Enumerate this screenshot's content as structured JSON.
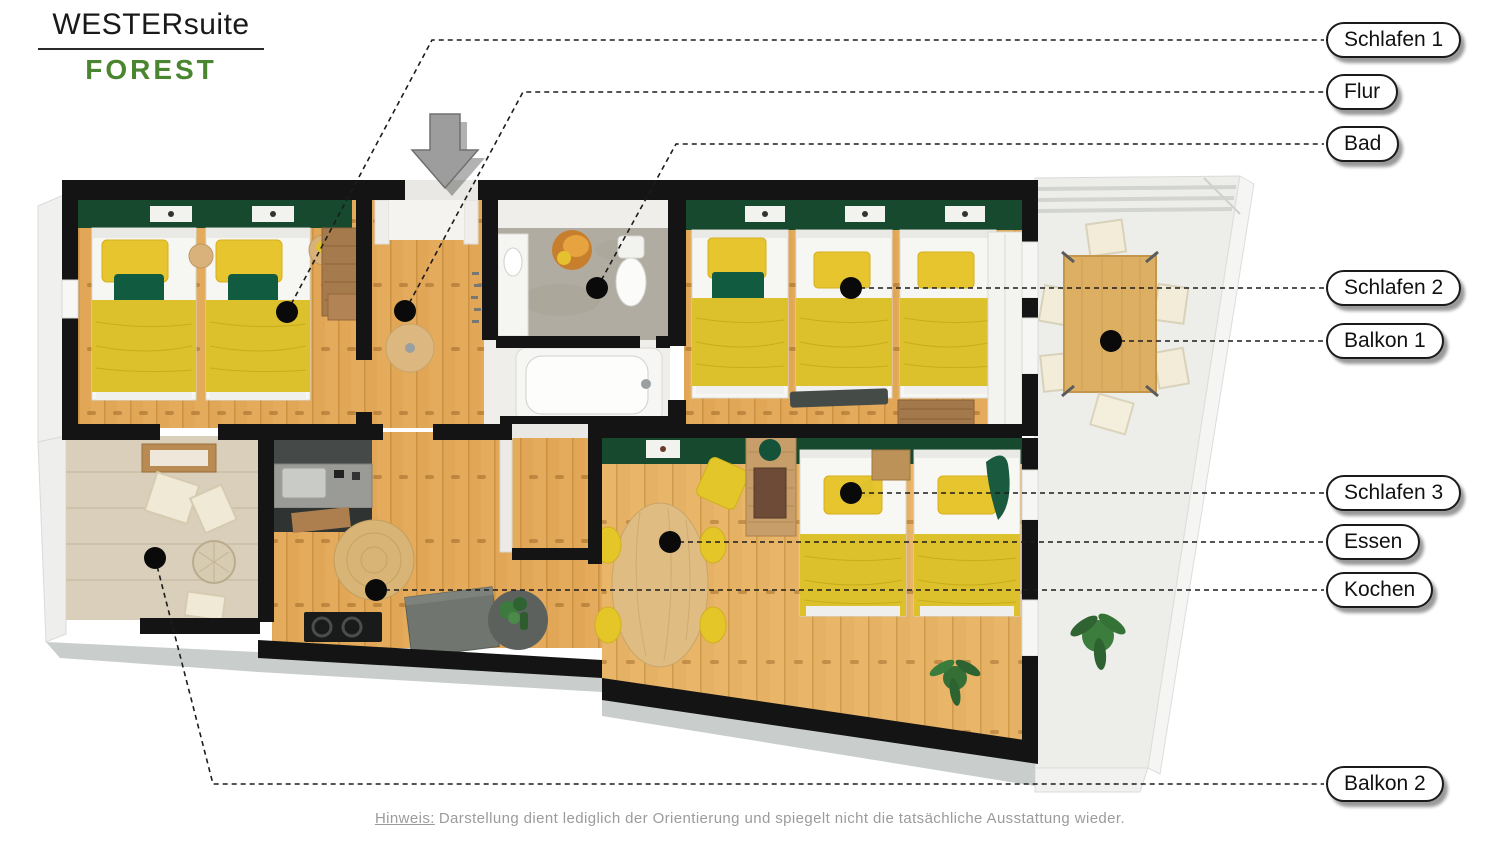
{
  "logo": {
    "brand": "WESTERsuite",
    "variant": "FOREST"
  },
  "note": {
    "prefix": "Hinweis:",
    "text": "Darstellung dient lediglich der Orientierung und spiegelt nicht die tatsächliche Ausstattung wieder."
  },
  "colors": {
    "accent_green": "#4a8530",
    "wall_green": "#17492f",
    "wood_floor": "#e1a757",
    "blanket_yellow": "#ddc12c",
    "marker_black": "#0a0a0a",
    "wall_black": "#141414"
  },
  "labels": [
    {
      "id": "schlafen-1",
      "text": "Schlafen 1",
      "dot": [
        287,
        312
      ],
      "path": [
        [
          287,
          312
        ],
        [
          432,
          40
        ],
        [
          1324,
          40
        ]
      ],
      "pill_y": 40
    },
    {
      "id": "flur",
      "text": "Flur",
      "dot": [
        405,
        311
      ],
      "path": [
        [
          405,
          311
        ],
        [
          523,
          92
        ],
        [
          1324,
          92
        ]
      ],
      "pill_y": 92
    },
    {
      "id": "bad",
      "text": "Bad",
      "dot": [
        597,
        288
      ],
      "path": [
        [
          597,
          288
        ],
        [
          676,
          144
        ],
        [
          1324,
          144
        ]
      ],
      "pill_y": 144
    },
    {
      "id": "schlafen-2",
      "text": "Schlafen 2",
      "dot": [
        851,
        288
      ],
      "path": [
        [
          851,
          288
        ],
        [
          1324,
          288
        ]
      ],
      "pill_y": 288
    },
    {
      "id": "balkon-1",
      "text": "Balkon 1",
      "dot": [
        1111,
        341
      ],
      "path": [
        [
          1111,
          341
        ],
        [
          1324,
          341
        ]
      ],
      "pill_y": 341
    },
    {
      "id": "schlafen-3",
      "text": "Schlafen 3",
      "dot": [
        851,
        493
      ],
      "path": [
        [
          851,
          493
        ],
        [
          1324,
          493
        ]
      ],
      "pill_y": 493
    },
    {
      "id": "essen",
      "text": "Essen",
      "dot": [
        670,
        542
      ],
      "path": [
        [
          670,
          542
        ],
        [
          1324,
          542
        ]
      ],
      "pill_y": 542
    },
    {
      "id": "kochen",
      "text": "Kochen",
      "dot": [
        376,
        590
      ],
      "path": [
        [
          376,
          590
        ],
        [
          1324,
          590
        ]
      ],
      "pill_y": 590
    },
    {
      "id": "balkon-2",
      "text": "Balkon 2",
      "dot": [
        155,
        558
      ],
      "path": [
        [
          155,
          558
        ],
        [
          213,
          784
        ],
        [
          1324,
          784
        ]
      ],
      "pill_y": 784
    }
  ]
}
